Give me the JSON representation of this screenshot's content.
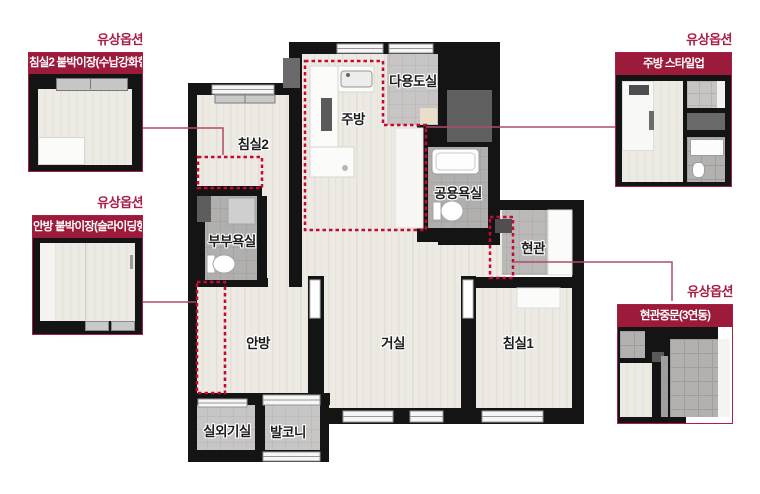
{
  "plan": {
    "rooms": [
      {
        "id": "bedroom2",
        "label": "침실2"
      },
      {
        "id": "kitchen",
        "label": "주방"
      },
      {
        "id": "utility",
        "label": "다용도실"
      },
      {
        "id": "common-bath",
        "label": "공용욕실"
      },
      {
        "id": "entrance",
        "label": "현관"
      },
      {
        "id": "master-bath",
        "label": "부부욕실"
      },
      {
        "id": "master-bedroom",
        "label": "안방"
      },
      {
        "id": "living",
        "label": "거실"
      },
      {
        "id": "bedroom1",
        "label": "침실1"
      },
      {
        "id": "outdoor-unit",
        "label": "실외기실"
      },
      {
        "id": "balcony",
        "label": "발코니"
      }
    ]
  },
  "callouts": [
    {
      "id": "bedroom2-closet",
      "tag": "유상옵션",
      "title": "침실2 붙박이장(수납강화형)"
    },
    {
      "id": "master-closet",
      "tag": "유상옵션",
      "title": "안방 붙박이장(슬라이딩형)"
    },
    {
      "id": "kitchen-styleup",
      "tag": "유상옵션",
      "title": "주방 스타일업"
    },
    {
      "id": "entrance-door",
      "tag": "유상옵션",
      "title": "현관중문(3연동)"
    }
  ],
  "colors": {
    "wall": "#141414",
    "callout_header_bg": "#9c1b3b",
    "callout_border": "#a72048",
    "tag_text": "#a71f45",
    "option_dashed": "#c40a2e",
    "connector_line": "#b14a68",
    "wood_floor": "#edeae4",
    "bath_tile": "#b2b1b0"
  }
}
